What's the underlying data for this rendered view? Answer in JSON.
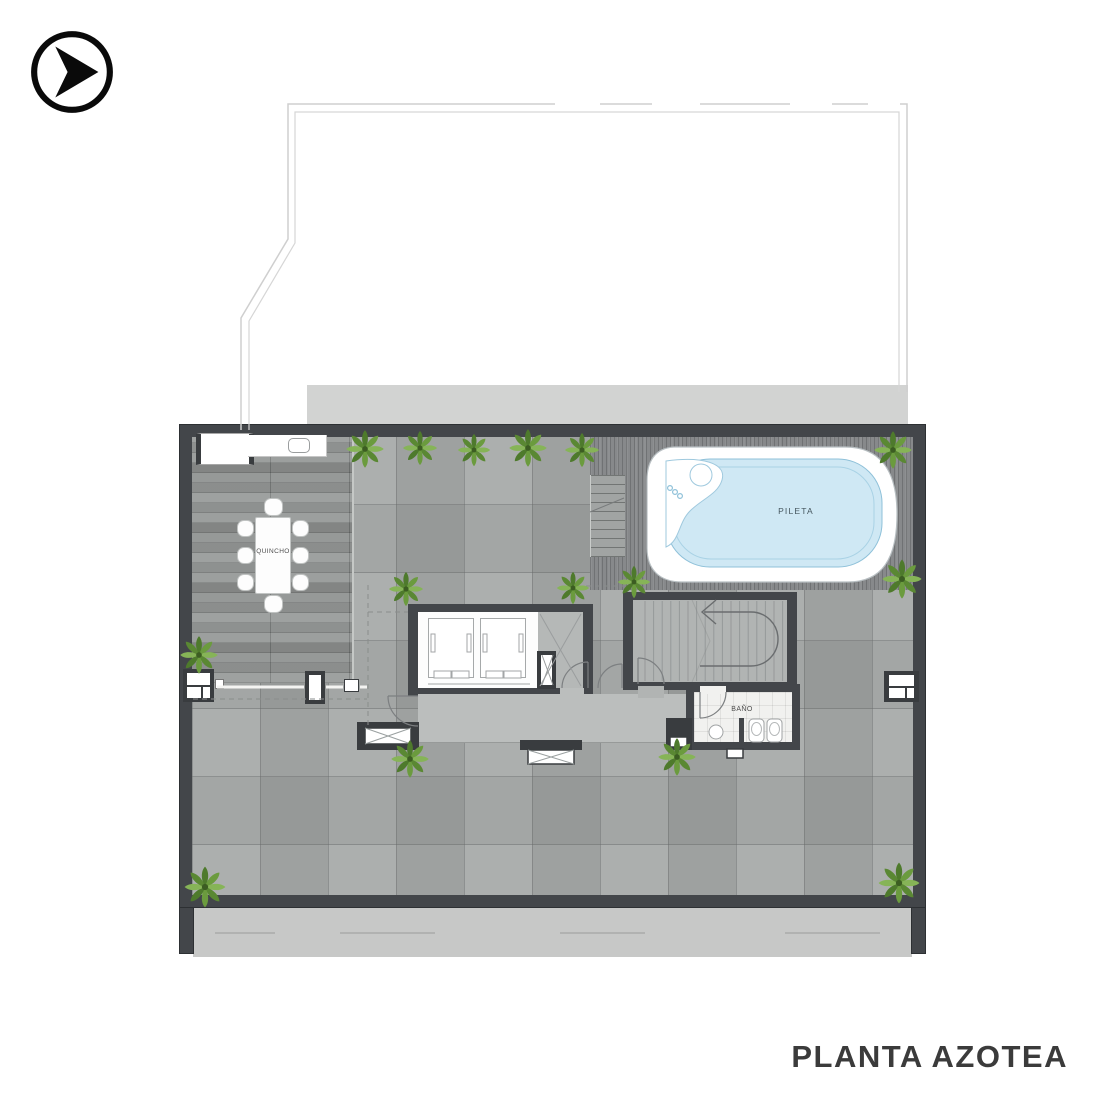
{
  "header": {
    "logo_icon": "arrow-play-logo"
  },
  "floorplan": {
    "title": "PLANTA AZOTEA",
    "labels": {
      "quincho": "QUINCHO",
      "pool": "PILETA",
      "bathroom": "BAÑO"
    }
  },
  "colors": {
    "wall": "#43464a",
    "tile_floor": "#a4a7a6",
    "wood_deck": "#969998",
    "pool_deck": "#87898b",
    "pool_water": "#cfe8f4",
    "corridor_slab": "#bbbebd",
    "site_band": "#d2d3d2",
    "plant_green": "#6b9b3e",
    "title_text": "#3b3b3b",
    "logo_black": "#0a0a0a"
  }
}
